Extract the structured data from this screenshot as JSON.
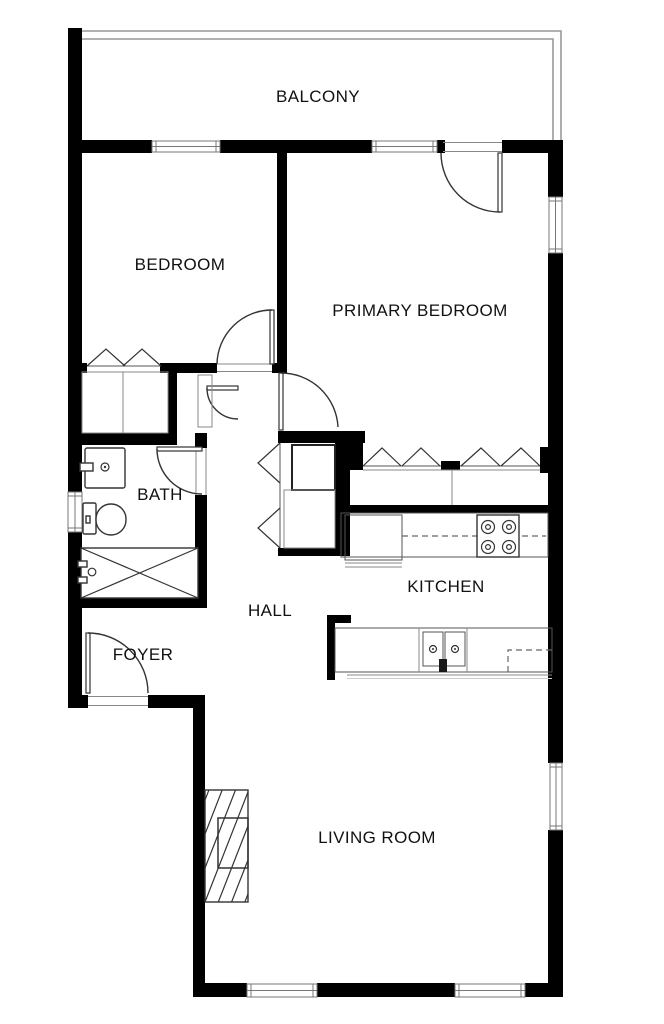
{
  "plan": {
    "rooms": [
      {
        "id": "balcony",
        "label": "BALCONY"
      },
      {
        "id": "bedroom",
        "label": "BEDROOM"
      },
      {
        "id": "primary-bedroom",
        "label": "PRIMARY BEDROOM"
      },
      {
        "id": "bath",
        "label": "BATH"
      },
      {
        "id": "kitchen",
        "label": "KITCHEN"
      },
      {
        "id": "hall",
        "label": "HALL"
      },
      {
        "id": "foyer",
        "label": "FOYER"
      },
      {
        "id": "living-room",
        "label": "LIVING ROOM"
      }
    ],
    "colors": {
      "wall": "#000000",
      "background": "#ffffff",
      "thin_line": "#555555",
      "window_frame": "#777777",
      "railing": "#999999",
      "text": "#111111"
    }
  }
}
